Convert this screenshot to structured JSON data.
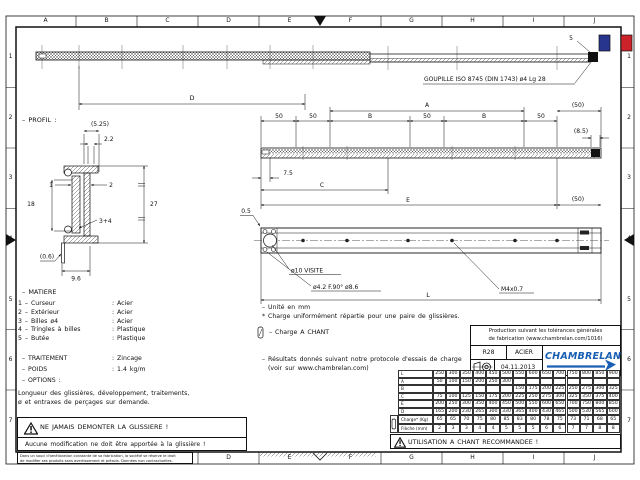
{
  "frame": {
    "columns": [
      "A",
      "B",
      "C",
      "D",
      "E",
      "F",
      "G",
      "H",
      "I",
      "J"
    ],
    "rows": [
      "1",
      "2",
      "3",
      "4",
      "5",
      "6",
      "7"
    ]
  },
  "flag": {
    "blue": "#28358f",
    "red": "#cc2229"
  },
  "callouts": {
    "pin_ref": "5",
    "goupille": "GOUPILLE ISO 8745 (DIN 1743) ø4 Lg 28",
    "hole_visite": "ø10 VISITE",
    "hole_countersunk": "ø4.2 F.90° ø8.6",
    "thread": "M4x0.7"
  },
  "dims": {
    "d": "D",
    "a": "A",
    "b": "B",
    "c": "C",
    "e": "E",
    "l": "L",
    "fifty": "50",
    "fifty_ref": "(50)",
    "eight_five": "(8.5)",
    "seven_five": "7.5",
    "half": "0.5"
  },
  "profile": {
    "title": "– PROFIL :",
    "depth_ref": "(5.25)",
    "wall": "2.2",
    "item1": "1",
    "item2": "2",
    "inner_height": "18",
    "outer_height": "27",
    "item34": "3+4",
    "thin_wall": "(0.6)",
    "base_depth": "9.6"
  },
  "notes": {
    "unit": "– Unité en mm",
    "load": "* Charge uniformément répartie pour une paire de glissières.",
    "chant": "– Charge A CHANT",
    "results1": "– Résultats donnés suivant notre protocole d'essais de charge",
    "results2": "(voir sur www.chambrelan.com)"
  },
  "matiere": {
    "title": "– MATIERE",
    "items": [
      {
        "label": "1  –  Curseur",
        "value": ": Acier"
      },
      {
        "label": "2  –  Extérieur",
        "value": ": Acier"
      },
      {
        "label": "3  –  Billes ø4",
        "value": ": Acier"
      },
      {
        "label": "4  –  Tringles à billes",
        "value": ": Plastique"
      },
      {
        "label": "5  –  Butée",
        "value": ": Plastique"
      }
    ],
    "traitement_label": "– TRAITEMENT",
    "traitement_value": ": Zincage",
    "poids_label": "– POIDS",
    "poids_value": ": 1.4  kg/m",
    "options_label": "– OPTIONS :",
    "options_text1": "Longueur des glissières, développement, traitements,",
    "options_text2": "ø et entraxes de perçages sur demande."
  },
  "warning": {
    "line1": "NE JAMAIS DEMONTER LA GLISSIERE !",
    "line2": "Aucune modification ne doit être apportée à la glissière !",
    "fine_print1": "Dans un souci d'amélioration constante de sa fabrication, la société se réserve le droit",
    "fine_print2": "de modifier ses produits sans avertissement et préavis. Données non contractuelles."
  },
  "title_block": {
    "tolerances_line1": "Production suivant les tolérances générales",
    "tolerances_line2": "de fabrication (www.chambrelan.com/1016)",
    "model": "R28",
    "material": "ACIER",
    "date": "04.11.2013",
    "brand": "CHAMBRELAN",
    "brand_color": "#1a5fb4"
  },
  "load_table": {
    "rows": [
      {
        "label": "L",
        "values": [
          "250",
          "300",
          "350",
          "400",
          "450",
          "500",
          "550",
          "600",
          "650",
          "700",
          "750",
          "800",
          "850",
          "900"
        ]
      },
      {
        "label": "A",
        "values": [
          "50",
          "100",
          "150",
          "200",
          "250",
          "300",
          "",
          "",
          "",
          "",
          "",
          "",
          "",
          ""
        ]
      },
      {
        "label": "B",
        "values": [
          "",
          "",
          "",
          "",
          "",
          "",
          "150",
          "175",
          "200",
          "225",
          "250",
          "275",
          "300",
          "325"
        ]
      },
      {
        "label": "C",
        "values": [
          "75",
          "100",
          "125",
          "150",
          "175",
          "200",
          "225",
          "250",
          "275",
          "300",
          "325",
          "350",
          "375",
          "400"
        ]
      },
      {
        "label": "E",
        "values": [
          "200",
          "250",
          "300",
          "350",
          "400",
          "450",
          "500",
          "550",
          "600",
          "650",
          "700",
          "750",
          "800",
          "850"
        ]
      },
      {
        "label": "D",
        "values": [
          "165",
          "200",
          "230",
          "265",
          "300",
          "330",
          "365",
          "400",
          "430",
          "465",
          "500",
          "530",
          "565",
          "600"
        ]
      }
    ],
    "charge_row": {
      "label": "Charge* (Kg)",
      "values": [
        "65",
        "65",
        "70",
        "75",
        "80",
        "85",
        "83",
        "80",
        "78",
        "75",
        "73",
        "71",
        "68",
        "65"
      ]
    },
    "fleche_row": {
      "label": "Flèche (mm)",
      "values": [
        "2",
        "3",
        "3",
        "4",
        "4",
        "5",
        "5",
        "5",
        "6",
        "6",
        "7",
        "7",
        "8",
        "8"
      ]
    }
  },
  "usage_note": "UTILISATION A CHANT RECOMMANDEE !"
}
